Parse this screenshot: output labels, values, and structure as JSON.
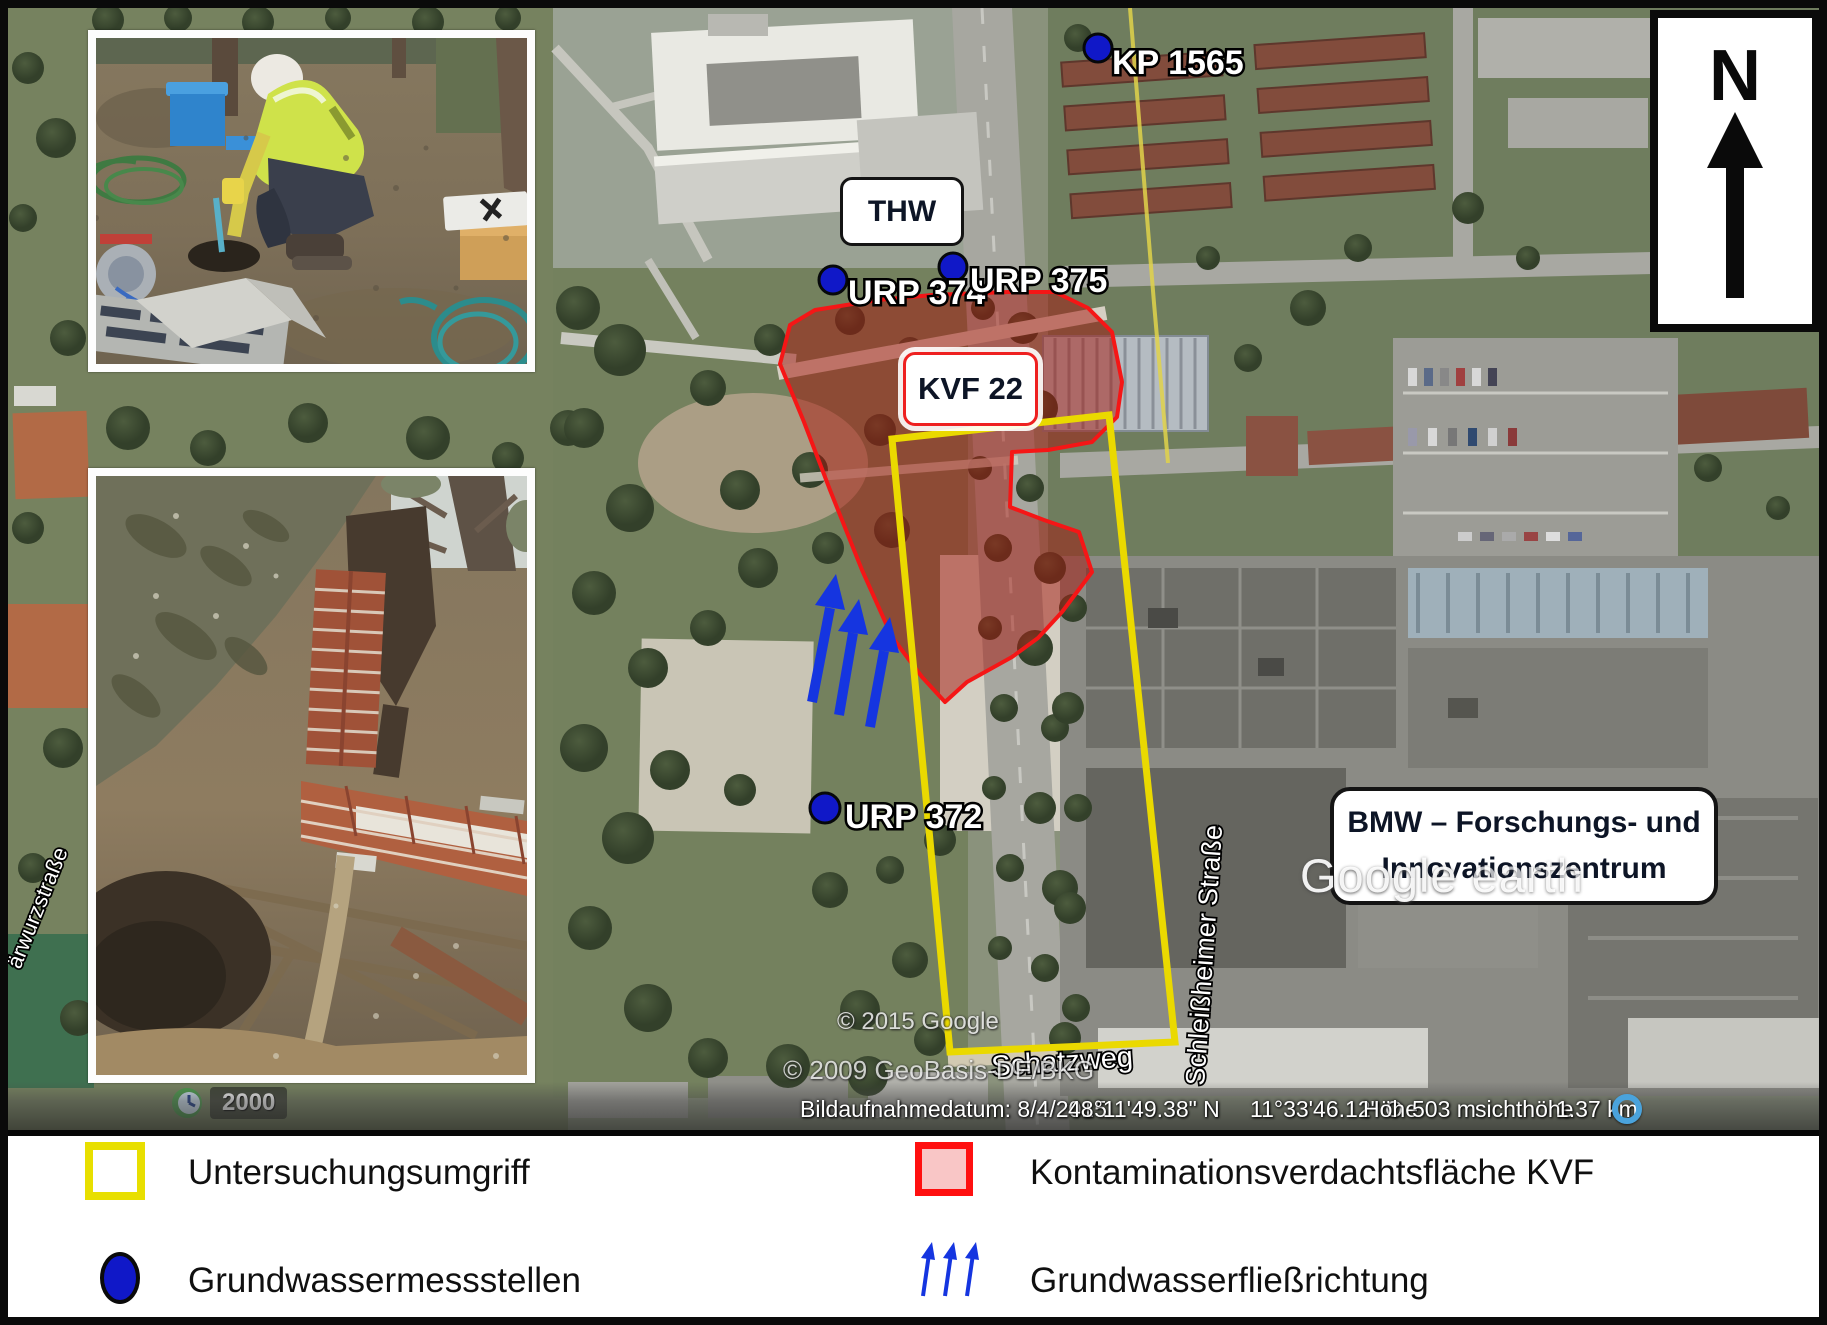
{
  "legend": {
    "items": [
      {
        "key": "untersuchungsumgriff",
        "label": "Untersuchungsumgriff"
      },
      {
        "key": "kontaminationsverdachtsflaeche",
        "label": "Kontaminationsverdachtsfläche KVF"
      },
      {
        "key": "grundwassermessstellen",
        "label": "Grundwassermessstellen"
      },
      {
        "key": "grundwasserfliessrichtung",
        "label": "Grundwasserfließrichtung"
      }
    ]
  },
  "markers": {
    "kp1565": "KP 1565",
    "urp374": "URP 374",
    "urp375": "URP 375",
    "urp372": "URP 372"
  },
  "callouts": {
    "thw": "THW",
    "kvf": "KVF 22",
    "bmw_line1": "BMW – Forschungs- und",
    "bmw_line2": "Innovationszentrum"
  },
  "north_label": "N",
  "streets": {
    "schleissheimer": "Schleißheimer Straße",
    "schatzweg": "Schatzweg",
    "left_partial": "ärwurzstraße"
  },
  "watermark": {
    "google": "Google",
    "earth": "earth"
  },
  "copyright": {
    "google": "© 2015 Google",
    "geobasis": "© 2009 GeoBasis-DE/BKG"
  },
  "statusbar": {
    "date": "Bildaufnahmedatum: 8/4/2015",
    "lat": "48°11'49.38\" N",
    "lon": "11°33'46.12\" O",
    "elev_label": "Höhe",
    "elev_value": "503 m",
    "eye_label": "sichthöhe",
    "eye_value": "1.37 km"
  },
  "history_year": "2000",
  "colors": {
    "investigation_outline": "#ead900",
    "contamination_outline": "#f51616",
    "contamination_fill": "#f9c6c6",
    "groundwater_blue": "#1018c8",
    "arrow_blue": "#1535e0"
  }
}
